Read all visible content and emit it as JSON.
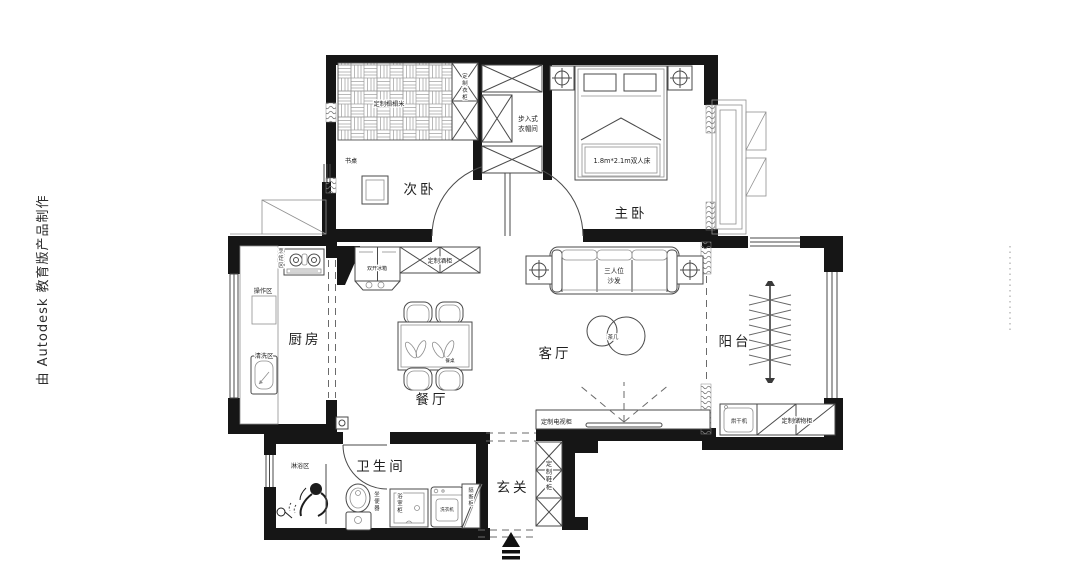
{
  "watermark": {
    "text": "由 Autodesk 教育版产品制作"
  },
  "rooms": {
    "secondary_bedroom": "次卧",
    "master_bedroom": "主卧",
    "kitchen": "厨房",
    "dining_room": "餐厅",
    "living_room": "客厅",
    "balcony": "阳台",
    "bathroom": "卫生间",
    "entry": "玄关",
    "walk_in_closet_line1": "步入式",
    "walk_in_closet_line2": "衣帽间"
  },
  "annotations": {
    "tatami": "定制榻榻米",
    "wardrobe": "定制衣柜",
    "desk": "书桌",
    "double_bed": "1.8m*2.1m双人床",
    "cooking_zone": "烹饪区",
    "prep_zone": "操作区",
    "washing_zone": "清洗区",
    "fridge": "双开冰箱",
    "wine_cabinet": "定制酒柜",
    "dining_table": "餐桌",
    "sofa_line1": "三人位",
    "sofa_line2": "沙发",
    "tea_table": "茶几",
    "tv_cabinet": "定制电视柜",
    "dryer": "烘干机",
    "storage_cabinet": "定制储物柜",
    "shower_zone": "淋浴区",
    "toilet": "坐便器",
    "bathroom_cabinet": "浴室柜",
    "washing_machine": "洗衣机",
    "partition_cabinet": "隔断柜",
    "shoe_cabinet": "定制鞋柜"
  },
  "colors": {
    "wall": "#161616",
    "line": "#4a4a4a",
    "accent": "#8f8f8f",
    "text": "#1f1f1f"
  }
}
